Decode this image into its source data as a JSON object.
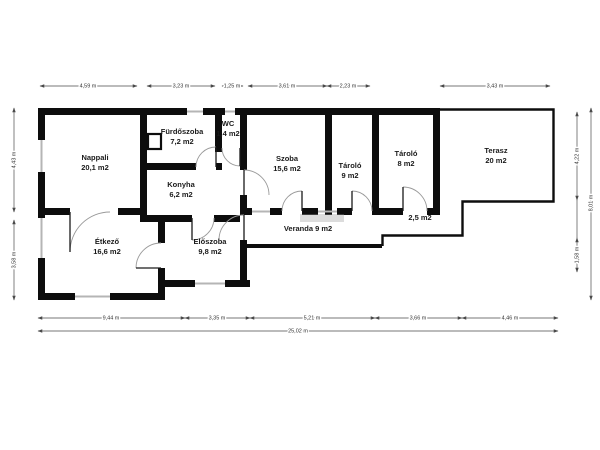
{
  "plan": {
    "rooms": {
      "nappali": {
        "name": "Nappali",
        "area": "20,1 m2"
      },
      "furdoszoba": {
        "name": "Fürdőszoba",
        "area": "7,2 m2"
      },
      "wc": {
        "name": "WC",
        "area": "1,4 m2"
      },
      "szoba": {
        "name": "Szoba",
        "area": "15,6 m2"
      },
      "tarolo_9": {
        "name": "Tároló",
        "area": "9 m2"
      },
      "tarolo_8": {
        "name": "Tároló",
        "area": "8 m2"
      },
      "terasz": {
        "name": "Terasz",
        "area": "20 m2"
      },
      "konyha": {
        "name": "Konyha",
        "area": "6,2 m2"
      },
      "etkezo": {
        "name": "Étkező",
        "area": "16,6 m2"
      },
      "eloszoba": {
        "name": "Előszoba",
        "area": "9,8 m2"
      },
      "veranda": {
        "label": "Veranda 9 m2"
      },
      "step_area": {
        "label": "2,5 m2"
      }
    },
    "dimensions": {
      "top": [
        "4,59 m",
        "3,23 m",
        "1,25 m",
        "3,61 m",
        "2,23 m",
        "3,43 m"
      ],
      "bottom": [
        "9,44 m",
        "3,35 m",
        "5,21 m",
        "3,66 m",
        "4,46 m"
      ],
      "bottom_total": "25,02 m",
      "left": [
        "4,43 m",
        "3,58 m"
      ],
      "right_inner": [
        "4,22 m",
        "1,58 m"
      ],
      "right_outer": "8,01 m"
    },
    "colors": {
      "wall": "#0d0d0d",
      "window": "#b5b5b5",
      "door_arc": "#9a9a9a",
      "dimension": "#4a4a4a",
      "background": "#ffffff"
    }
  }
}
